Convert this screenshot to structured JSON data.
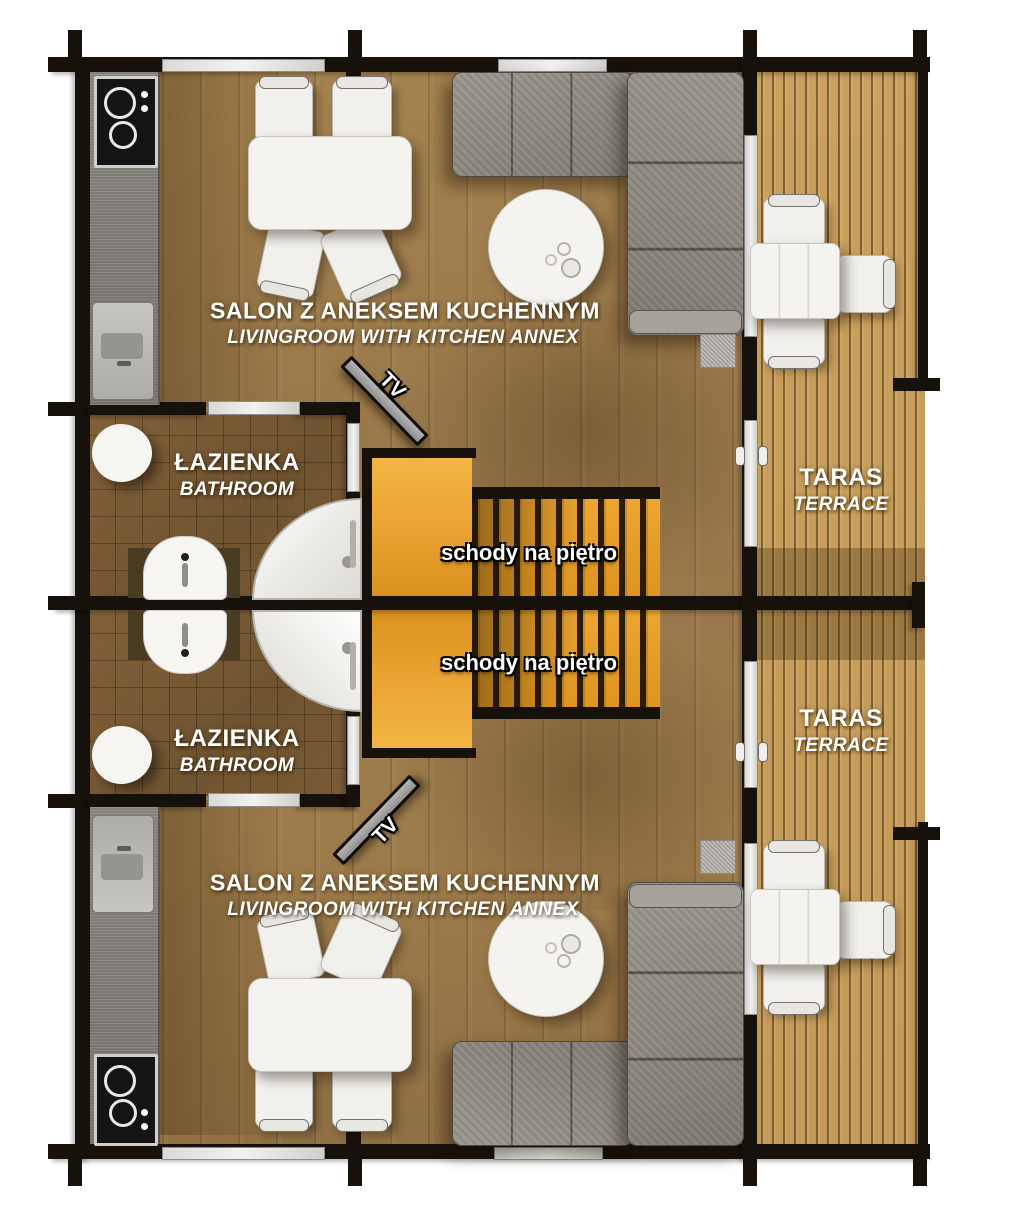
{
  "plan_title": "duplex ground floor plan",
  "rooms": {
    "salon_top": {
      "pl": "SALON Z ANEKSEM KUCHENNYM",
      "en": "LIVINGROOM WITH KITCHEN ANNEX"
    },
    "salon_bottom": {
      "pl": "SALON Z ANEKSEM KUCHENNYM",
      "en": "LIVINGROOM WITH KITCHEN ANNEX"
    },
    "bathroom_top": {
      "pl": "ŁAZIENKA",
      "en": "BATHROOM"
    },
    "bathroom_bottom": {
      "pl": "ŁAZIENKA",
      "en": "BATHROOM"
    },
    "terrace_top": {
      "pl": "TARAS",
      "en": "TERRACE"
    },
    "terrace_bottom": {
      "pl": "TARAS",
      "en": "TERRACE"
    },
    "stairs_top": {
      "label": "schody na piętro"
    },
    "stairs_bottom": {
      "label": "schody na piętro"
    },
    "tv_top": {
      "label": "TV"
    },
    "tv_bottom": {
      "label": "TV"
    }
  },
  "colors": {
    "wall": "#16110b",
    "wood_floor": "#9e7c4c",
    "bathroom_tile": "#7a5c36",
    "terrace_deck": "#c9a05e",
    "stairs_accent": "#eda631",
    "sofa_gray": "#8f8b84",
    "furniture_white": "#f4f3f0",
    "label_text": "#ffffff"
  }
}
